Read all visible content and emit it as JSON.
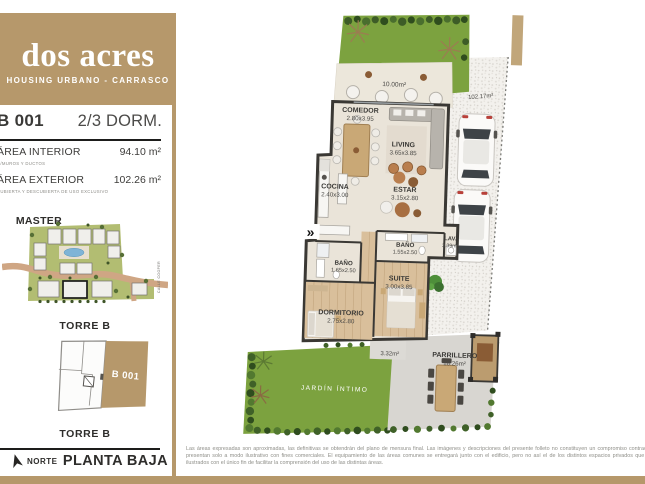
{
  "header": {
    "brand": "dos acres",
    "subtitle": "HOUSING URBANO - CARRASCO"
  },
  "unit": {
    "code": "B 001",
    "type": "2/3 DORM.",
    "interior": {
      "label": "ÁREA INTERIOR",
      "value": "94.10 m²",
      "note": "C/MUROS Y DUCTOS"
    },
    "exterior": {
      "label": "ÁREA EXTERIOR",
      "value": "102.26 m²",
      "note": "CUBIERTA Y DESCUBIERTA DE USO EXCLUSIVO"
    }
  },
  "master_plan": {
    "title_line1": "MASTER",
    "title_line2": "PLAN",
    "tower": "TORRE B",
    "street": "CALLE COOPER"
  },
  "tower_diagram": {
    "unit": "B 001",
    "label": "TORRE B"
  },
  "footer": {
    "north": "NORTE",
    "floor": "PLANTA BAJA"
  },
  "plan": {
    "rooms": {
      "comedor": {
        "name": "COMEDOR",
        "dims": "2.80x3.95"
      },
      "living": {
        "name": "LIVING",
        "dims": "3.65x3.85"
      },
      "cocina": {
        "name": "COCINA",
        "dims": "2.40x3.00"
      },
      "estar": {
        "name": "ESTAR",
        "dims": "3.15x2.80"
      },
      "banio_suite": {
        "name": "BAÑO",
        "dims": "1.55x2.50"
      },
      "banio_social": {
        "name": "BAÑO",
        "dims": "1.65x2.50"
      },
      "suite": {
        "name": "SUITE",
        "dims": "3.00x3.85"
      },
      "dormitorio": {
        "name": "DORMITORIO",
        "dims": "2.75x2.80"
      },
      "lavadero": {
        "name": "LAV.",
        "dims": "3.39m²"
      },
      "parrillero": {
        "name": "PARRILLERO",
        "dims": "18.26m²"
      }
    },
    "areas": {
      "terraza": "10.00m²",
      "exterior": "102.17m²",
      "patio": "3.32m²",
      "jardin": "JARDÍN ÍNTIMO"
    },
    "entry_marker": "»"
  },
  "disclaimer": "Las áreas expresadas son aproximadas, las definitivas se obtendrán del plano de mensura final. Las imágenes y descripciones del presente folleto no constituyen un compromiso contractual y se presentan solo a modo ilustrativo con fines comerciales. El equipamiento de las áreas comunes se entregará junto con el edificio, pero no así el de los distintos espacios privados que son aquí ilustrados con el único fin de facilitar la comprensión del uso de las distintas áreas.",
  "colors": {
    "accent": "#b6986b",
    "wall": "#3a3834",
    "lawn": "#7ca23f",
    "wood": "#d9bf9b",
    "pool": "#7fb4d6",
    "gravel": "#f3f1ed"
  }
}
